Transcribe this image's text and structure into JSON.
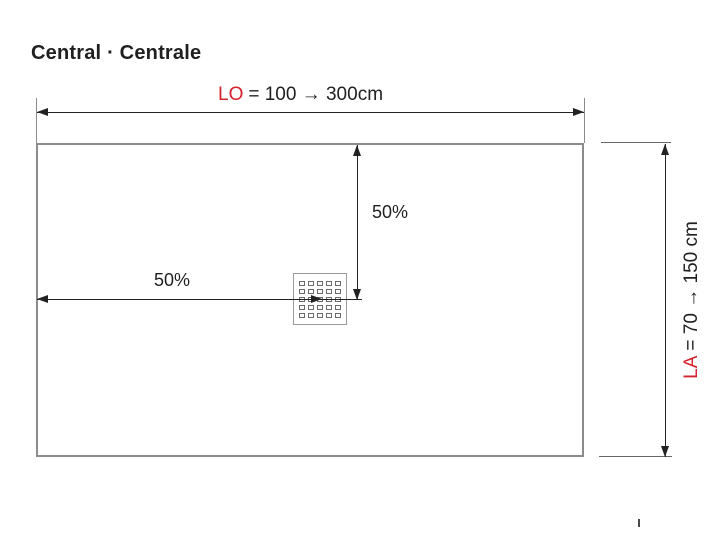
{
  "title": "Central · Centrale",
  "colors": {
    "accent_red": "#d5232e",
    "ink": "#1f1f1f",
    "dim_line": "#222222",
    "tray_border": "#8c8c8c",
    "drain_border": "#9a9a9a",
    "hole_border": "#6b6b6b"
  },
  "dimensions": {
    "length": {
      "label": "LO",
      "value": "= 100 → 300cm"
    },
    "width": {
      "label": "LA",
      "value": "= 70 → 150 cm"
    },
    "drain_horizontal_position": "50%",
    "drain_vertical_position": "50%"
  },
  "drain": {
    "grid_rows": 5,
    "grid_cols": 5
  }
}
